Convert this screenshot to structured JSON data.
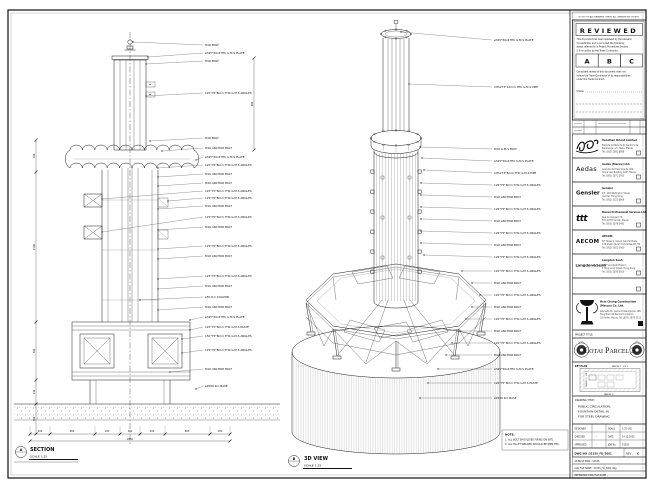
{
  "sheet": {
    "edge_note": "DO NOT SCALE DRAWING. VERIFY ALL DIMENSIONS ON SITE."
  },
  "section": {
    "bubble": "A",
    "label": "SECTION",
    "scale": "SCALE 1:25",
    "callouts": [
      "M16 BOLT",
      "ø345*50x4THK G.M.S PLATE",
      "M16 BOLT",
      "125*75*8mm THK G.M.S ANGLES",
      "M16 BOLT",
      "M16 ANCHOR BOLT",
      "ø345*50x4THK G.M.S PLATE",
      "125*75*8mm THK G.M.S ANGLES",
      "M16 ANCHOR BOLT",
      "M16 ANCHOR BOLT",
      "125*75*8mm THK G.M.S ANGLES",
      "125*75*8mm THK G.M.S ANGLES",
      "M16 ANCHOR BOLT",
      "125*75*8mm THK G.M.S ANGLES",
      "M16 ANCHOR BOLT",
      "125*75*8mm THK G.M.S ANGLES",
      "M16 ANCHOR BOLT",
      "125*75*8mm THK G.M.S ANGLES",
      "M16 ANCHOR BOLT",
      "ø50 R.C COLUMN",
      "M16 ANCHOR BOLT",
      "ø345*50x4THK G.M.S PLATE",
      "125*75*8mm THK G.M.S PLATE",
      "150*75*8mm THK G.M.S ANGLES",
      "125*75*8mm THK G.M.S ANGLES",
      "M16 ANCHOR BOLT",
      "ø2500 R.C BASE"
    ],
    "dims_bottom": [
      "200",
      "800",
      "200",
      "450",
      "200",
      "800",
      "200"
    ],
    "dim_total": "2850",
    "dims_left": [
      "320",
      "1500",
      "580",
      "240",
      "300"
    ],
    "dim_right": "900"
  },
  "iso": {
    "bubble": "B",
    "label": "3D VIEW",
    "scale": "SCALE 1:25",
    "callouts": [
      "ø345*50x4THK G.M.S PLATE",
      "CHS273*12mm THK G.M.S PIPE",
      "M16 G.M.S BOLT",
      "ø345*50x4THK G.M.S PLATE",
      "CHS273*8mm THK G.M.S PIPE",
      "125*75*8mm THK G.M.S ANGLES",
      "M16 ANCHOR BOLT",
      "125*75*8mm THK G.M.S ANGLES",
      "M16 ANCHOR BOLT",
      "125*75*8mm THK G.M.S ANGLES",
      "M16 ANCHOR BOLT",
      "125*75*8mm THK G.M.S ANGLES",
      "125*75*8mm THK G.M.S ANGLES",
      "M16 ANCHOR BOLT",
      "125*75*8mm THK G.M.S ANGLES",
      "M16 ANCHOR BOLT",
      "125*75*8mm THK G.M.S ANGLES",
      "M16 ANCHOR BOLT",
      "125*75*8mm THK G.M.S ANGLES",
      "M16 ANCHOR BOLT",
      "ø345*50x4THK G.M.S PLATE",
      "125*75*8mm THK G.M.S PLATE",
      "ø2500 R.C BASE"
    ],
    "note_title": "NOTE:",
    "note_lines": [
      "1. ALL BOLT SHOULD BE FIXING ON SITE.",
      "2. ALL FILLET WELDED SHOULD BE 6MM THK."
    ]
  },
  "titleblock": {
    "reviewed": {
      "title": "REVIEWED",
      "para1": [
        "This document has been reviewed by the relevant",
        "Consultant(s) and is accorded the following",
        "status referred to in Project Procedures Section",
        "5.4 for action by the Trade Contractor."
      ],
      "options": [
        "A",
        "B",
        "C"
      ],
      "para2": [
        "Consultant review of this document does not",
        "relieve the Trade Contractor of its responsibilities",
        "under the Trade Contract."
      ],
      "date_label": "Date :"
    },
    "consultants": [
      {
        "logo": "",
        "name": "Venetian Orient Limited",
        "addr": [
          "Estrada da Baía de N. Senhora da",
          "Esperança, s/n, Taipa, Macau",
          "Tel: (853) 2882 8888"
        ]
      },
      {
        "logo": "Aedas",
        "name": "Aedas (Macau) Ltd.",
        "addr": [
          "Avenida da Praia Grande 409,",
          "China Law Building 16/F, Macau",
          "Tel: (853) 2871 5953"
        ]
      },
      {
        "logo": "Gensler",
        "name": "Gensler",
        "addr": [
          "2/F, 128 Wellington Street,",
          "Central, Hong Kong",
          "Tel: (852) 2523 8866"
        ]
      },
      {
        "logo": "ttt",
        "name": "Macau Professional Services Ltd.",
        "addr": [
          "Rua de Xangai 175,",
          "Edf. ACM 8 Andar, Macau",
          "Tel: (853) 2878 5483"
        ]
      },
      {
        "logo": "AECOM",
        "name": "AECOM",
        "addr": [
          "8/F Tower 2, Grand Central Plaza,",
          "138 Shatin Rural Committee Rd, HK",
          "Tel: (852) 3922 9000"
        ]
      },
      {
        "logo": "Langdon&Seah",
        "name": "Langdon Seah",
        "addr": [
          "19/F Soundwill Plaza II,",
          "1 Tang Lung Street, Hong Kong",
          "Tel: (852) 2830 3500"
        ]
      }
    ],
    "contractor": {
      "name1": "Hsin Chong Construction",
      "name2": "(Macau) Co. Ltd.",
      "addr": [
        "Alameda Dr. Carlos D'Assumpção 180,",
        "Tong Nam Ah Central Comércio,",
        "19 Andar, Macau  Tel: (853) 2875 3511"
      ]
    },
    "project_title_label": "PROJECT TITLE:",
    "project_title": "Cotai Parcel 3",
    "key_plan": {
      "label": "KEY PLAN",
      "parcel_top": "PARCEL 1, LOT 2",
      "parcel_left": "PARCEL 1, LOT 1",
      "parcel_bottom": "PARCEL 3"
    },
    "drawing_title_label": "DRAWING TITLE:",
    "drawing_title": [
      "PUBLIC CIRCULATION,",
      "FOUNTAIN DETAIL IN",
      "FOR STEEL DRAWING"
    ],
    "signoff": {
      "r1k": "DESIGNED",
      "r1v": "",
      "r1k2": "SCALE",
      "r1v2": "1:25 (A1)",
      "r2k": "CHECKED",
      "r2v": "-",
      "r2k2": "DATE",
      "r2v2": "14.12.2015",
      "r3k": "APPROVED",
      "r3v": "-",
      "r3k2": "JOB No.",
      "r3v2": "51535"
    },
    "dwg_label": "DWG NO :",
    "dwg_no": "51535_FD_5001",
    "rev_label": "REV :",
    "rev": "C",
    "file_rows": [
      "AS BUILT DWG : 51535",
      "CAD FILE NAME : 51535_FD_5001.dwg",
      "REFERENCE DWG FILE NAME :"
    ]
  }
}
